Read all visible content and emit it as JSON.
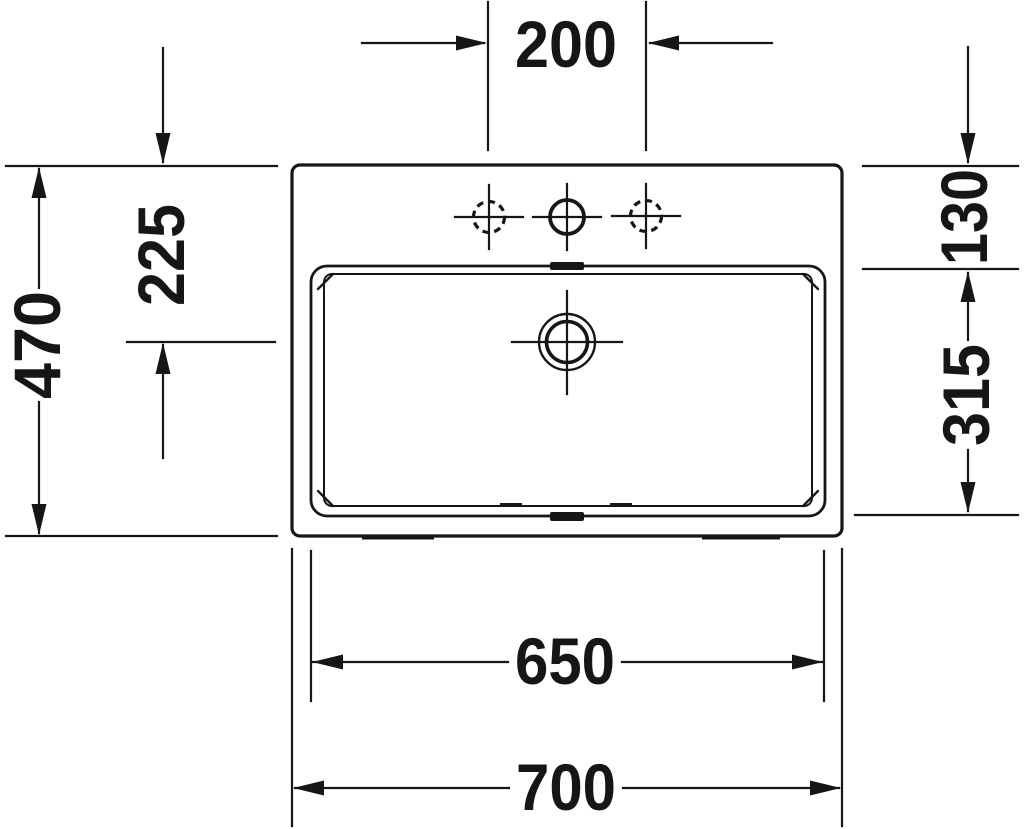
{
  "drawing": {
    "title": "Washbasin dimension drawing, top view",
    "background_color": "#ffffff",
    "line_color": "#161616",
    "dimensions": {
      "tap_hole_spacing": "200",
      "top_edge_to_drain": "225",
      "overall_depth": "470",
      "top_edge_to_basin": "130",
      "basin_inner_depth": "315",
      "basin_inner_width": "650",
      "overall_width": "700"
    }
  }
}
